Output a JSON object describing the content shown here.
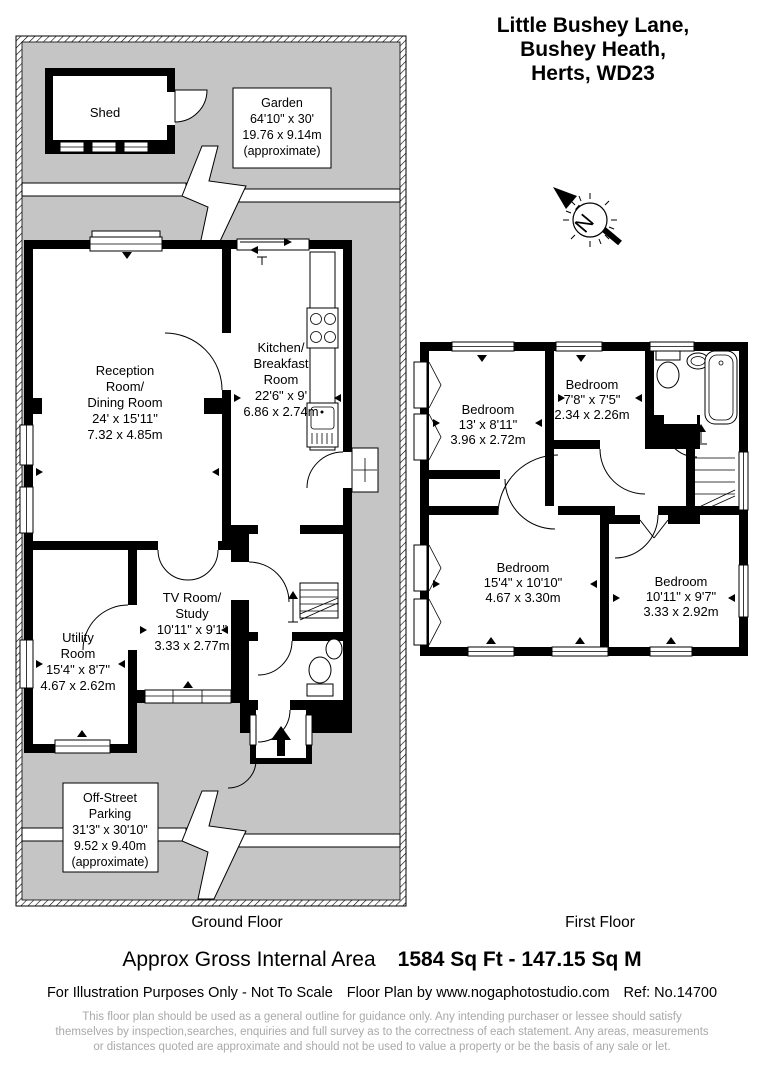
{
  "title": {
    "line1": "Little Bushey Lane,",
    "line2": "Bushey Heath,",
    "line3": "Herts, WD23"
  },
  "compass": {
    "north_label": "N"
  },
  "ground_floor": {
    "caption": "Ground Floor",
    "shed_label": "Shed",
    "garden": {
      "lines": [
        "Garden",
        "64'10\" x 30'",
        "19.76 x 9.14m",
        "(approximate)"
      ]
    },
    "reception": {
      "lines": [
        "Reception",
        "Room/",
        "Dining Room",
        "24' x 15'11\"",
        "7.32 x 4.85m"
      ]
    },
    "kitchen": {
      "lines": [
        "Kitchen/",
        "Breakfast",
        "Room",
        "22'6\" x 9'",
        "6.86 x 2.74m"
      ]
    },
    "tv_room": {
      "lines": [
        "TV Room/",
        "Study",
        "10'11\" x 9'1\"",
        "3.33 x 2.77m"
      ]
    },
    "utility": {
      "lines": [
        "Utility",
        "Room",
        "15'4\" x 8'7\"",
        "4.67 x 2.62m"
      ]
    },
    "parking": {
      "lines": [
        "Off-Street",
        "Parking",
        "31'3\" x 30'10\"",
        "9.52 x 9.40m",
        "(approximate)"
      ]
    }
  },
  "first_floor": {
    "caption": "First Floor",
    "bedroom_13": {
      "lines": [
        "Bedroom",
        "13' x 8'11\"",
        "3.96 x 2.72m"
      ]
    },
    "bedroom_7": {
      "lines": [
        "Bedroom",
        "7'8\" x 7'5\"",
        "2.34 x 2.26m"
      ]
    },
    "bedroom_15": {
      "lines": [
        "Bedroom",
        "15'4\" x 10'10\"",
        "4.67 x 3.30m"
      ]
    },
    "bedroom_10": {
      "lines": [
        "Bedroom",
        "10'11\" x 9'7\"",
        "3.33 x 2.92m"
      ]
    }
  },
  "footer": {
    "area_label": "Approx Gross Internal Area",
    "area_value": "1584 Sq Ft  -  147.15 Sq M",
    "note": "For Illustration Purposes Only - Not To Scale",
    "credit": "Floor Plan by www.nogaphotostudio.com",
    "reference": "Ref: No.14700",
    "disclaimer": [
      "This floor plan should be used as a general outline for guidance only. Any intending purchaser or lessee should satisfy",
      "themselves by inspection,searches, enquiries and full survey as to the correctness of each statement. Any areas, measurements",
      "or distances quoted are approximate and should not be used to value a property or be the basis of any sale or let."
    ]
  },
  "colors": {
    "ground": "#c5c5c5",
    "walls": "#000000",
    "disclaimer_text": "#a9a9a9"
  }
}
